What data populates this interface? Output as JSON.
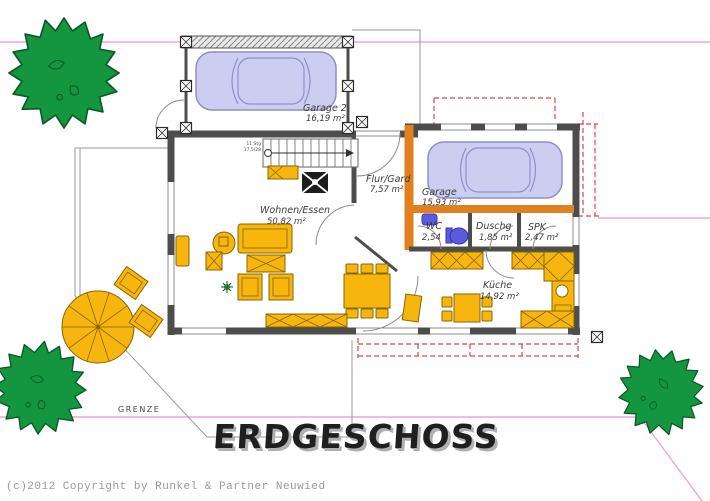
{
  "plan": {
    "title": "ERDGESCHOSS",
    "boundary_label": "GRENZE",
    "copyright": "(c)2012 Copyright by Runkel & Partner Neuwied"
  },
  "rooms": {
    "garage2": {
      "name": "Garage 2",
      "area": "16,19 m²"
    },
    "garage": {
      "name": "Garage",
      "area": "15,93 m²"
    },
    "flur": {
      "name": "Flur/Gard",
      "area": "7,57 m²"
    },
    "wohnen": {
      "name": "Wohnen/Essen",
      "area": "50,82 m²"
    },
    "wc": {
      "name": "WC",
      "area": "2,54"
    },
    "duschg": {
      "name": "Duschg",
      "area": "1,85 m²"
    },
    "spk": {
      "name": "SPK",
      "area": "2,47 m²"
    },
    "kueche": {
      "name": "Küche",
      "area": "14,92 m²"
    }
  },
  "stairs": {
    "note_line1": "11 Stg",
    "note_line2": "17,5/28"
  },
  "colors": {
    "wall": "#4d4d4d",
    "accent-wall": "#e2801f",
    "furniture": "#f6b60d",
    "furniture-stroke": "#8a6400",
    "car": "#cdcdf1",
    "car-stroke": "#8f8fc9",
    "tree": "#149540",
    "tree-stroke": "#0a5a27",
    "boundary": "#f2a3d3",
    "annotation": "#e24444",
    "sanitary": "#5b5be0"
  }
}
